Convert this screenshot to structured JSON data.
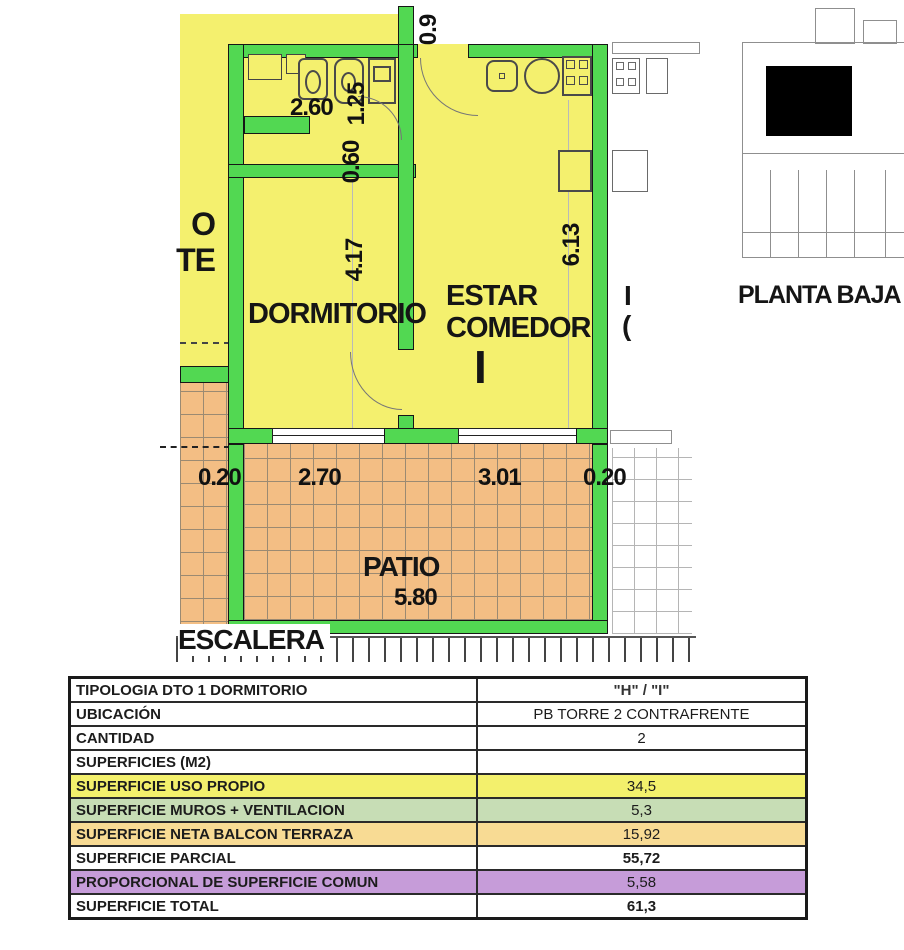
{
  "colors": {
    "unit_fill": "#F4F06E",
    "wall_green": "#52D852",
    "patio_fill": "#F3BE84",
    "row_yellow": "#F3F06C",
    "row_green": "#C7DDB5",
    "row_orange": "#F8DB94",
    "row_purple": "#C69CD9"
  },
  "plan": {
    "labels": {
      "dormitorio": "DORMITORIO",
      "estar_line1": "ESTAR",
      "estar_line2": "COMEDOR",
      "unit_mark": "I",
      "patio": "PATIO",
      "escalera": "ESCALERA",
      "left_partial_line1": "O",
      "left_partial_line2": "TE",
      "right_partial_mark1": "I",
      "right_partial_mark2": "("
    },
    "dimensions": {
      "bath_width": "2.60",
      "bath_depth": "1.25",
      "hall_width": "0.60",
      "dorm_length": "4.17",
      "estar_length": "6.13",
      "top_width": "0.9",
      "wall_left": "0.20",
      "dorm_width": "2.70",
      "estar_width": "3.01",
      "wall_right": "0.20",
      "patio_width": "5.80"
    }
  },
  "key_plan": {
    "caption": "PLANTA BAJA"
  },
  "table": {
    "rows": [
      {
        "label": "TIPOLOGIA  DTO 1 DORMITORIO",
        "value": "\"H\" / \"I\""
      },
      {
        "label": "UBICACIÓN",
        "value": "PB TORRE 2 CONTRAFRENTE"
      },
      {
        "label": "CANTIDAD",
        "value": "2"
      },
      {
        "label": "SUPERFICIES (M2)",
        "value": ""
      },
      {
        "label": "SUPERFICIE USO PROPIO",
        "value": "34,5"
      },
      {
        "label": "SUPERFICIE MUROS + VENTILACION",
        "value": "5,3"
      },
      {
        "label": "SUPERFICIE NETA BALCON TERRAZA",
        "value": "15,92"
      },
      {
        "label": "SUPERFICIE PARCIAL",
        "value": "55,72"
      },
      {
        "label": "PROPORCIONAL DE SUPERFICIE COMUN",
        "value": "5,58"
      },
      {
        "label": "SUPERFICIE TOTAL",
        "value": "61,3"
      }
    ]
  }
}
